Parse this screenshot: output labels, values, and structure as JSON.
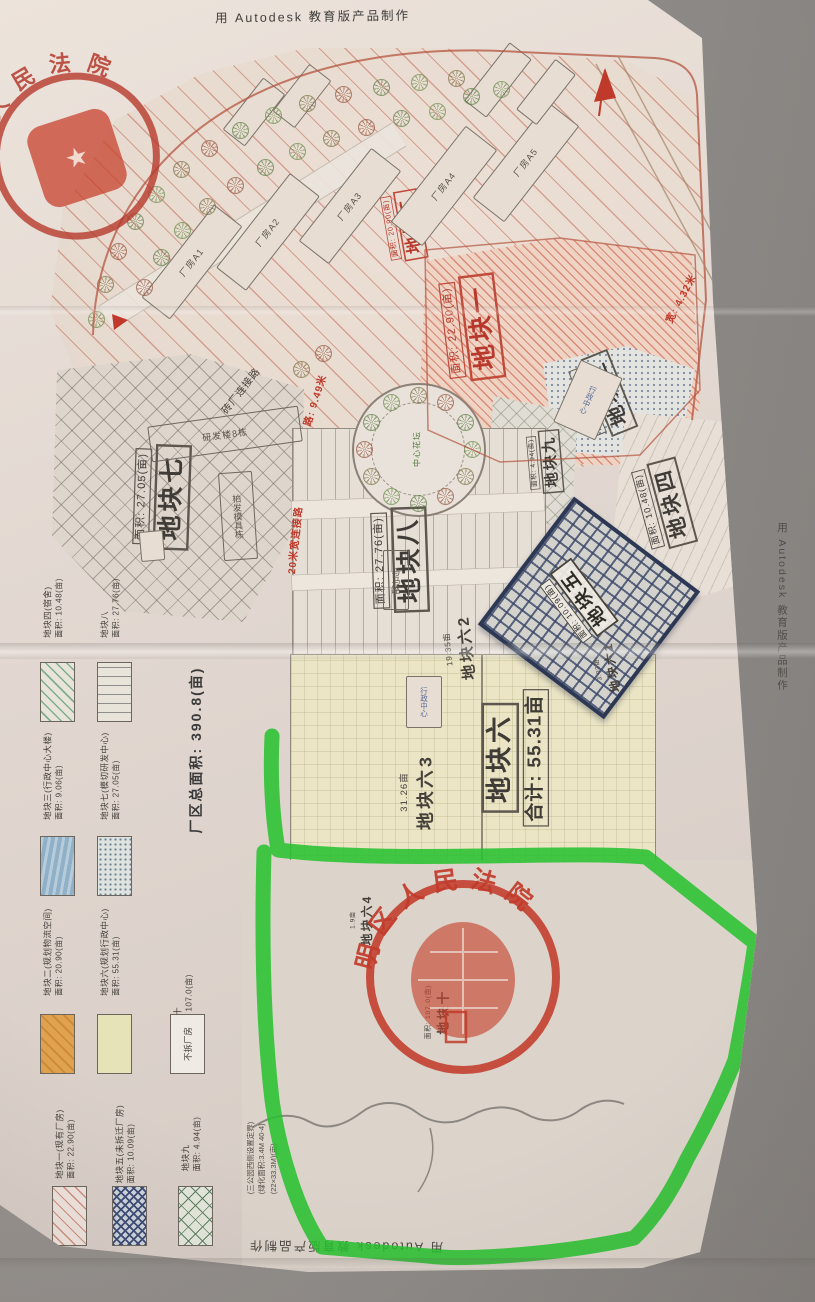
{
  "colors": {
    "marker_green": "#27c12f",
    "seal_red": "#c23b2a",
    "hatch_red": "#c05a46",
    "navy": "#35426b",
    "cream": "#ebe5c6"
  },
  "watermarks": {
    "top": "用 Autodesk 教育版产品制作",
    "bottom": "用 Autodesk 教育版产品制作",
    "right": "用 Autodesk 教育版产品制作"
  },
  "stamps": {
    "corner": {
      "arc_text": "人民法院"
    },
    "center": {
      "arc_text": "明区人民法院"
    }
  },
  "site": {
    "total_area": "厂区总面积: 390.8(亩)",
    "notes_l1": "(三公园西侧设置定界)",
    "notes_l2": "(绿化面积:3.4M 40-4)",
    "notes_l3": "(22×33.3M)(亩)"
  },
  "legend": {
    "items": [
      {
        "id": "p4",
        "x": 40,
        "ty": 556,
        "sy": 662,
        "sw": "hatch-green",
        "label": "地块四(宿舍)",
        "area": "面积: 10.48(亩)"
      },
      {
        "id": "p8",
        "x": 97,
        "ty": 556,
        "sy": 662,
        "sw": "lines-dash",
        "label": "地块八",
        "area": "面积: 27.76(亩)"
      },
      {
        "id": "p3",
        "x": 40,
        "ty": 724,
        "sy": 836,
        "sw": "solid-blue",
        "label": "地块三(行政中心大楼)",
        "area": "面积: 9.06(亩)"
      },
      {
        "id": "p7",
        "x": 97,
        "ty": 724,
        "sy": 836,
        "sw": "stipple",
        "label": "地块七(模切研发中心)",
        "area": "面积: 27.05(亩)"
      },
      {
        "id": "p2",
        "x": 40,
        "ty": 900,
        "sy": 1014,
        "sw": "solid-orange",
        "label": "地块二(规划物流空间)",
        "area": "面积: 20.90(亩)"
      },
      {
        "id": "p6",
        "x": 97,
        "ty": 900,
        "sy": 1014,
        "sw": "solid-cream",
        "label": "地块六(规划行政中心)",
        "area": "面积: 55.31(亩)"
      },
      {
        "id": "p10",
        "x": 170,
        "ty": 952,
        "sw": "none",
        "label": "地块十",
        "area": "面积: 107.0(亩)"
      },
      {
        "id": "keep",
        "x": 170,
        "sy": 1014,
        "sw": "box-empty",
        "label": "不拆厂房",
        "area": ""
      },
      {
        "id": "p1",
        "x": 52,
        "ty": 1092,
        "sy": 1186,
        "sw": "hatch-pink",
        "label": "地块一(现有厂房)",
        "area": "面积: 22.90(亩)"
      },
      {
        "id": "p5",
        "x": 112,
        "ty": 1092,
        "sy": 1186,
        "sw": "cross-navy",
        "label": "地块五(未拆迁厂房)",
        "area": "面积: 10.09(亩)"
      },
      {
        "id": "p9",
        "x": 178,
        "ty": 1092,
        "sy": 1186,
        "sw": "grid-green",
        "label": "地块九",
        "area": "面积: 4.94(亩)"
      }
    ]
  },
  "map": {
    "parcel_labels": [
      {
        "id": "p1",
        "name": "地块一",
        "area": "面积: 22.90(亩)",
        "style": "red",
        "x": 472,
        "y": 328,
        "rot": -97,
        "scale": 1.2
      },
      {
        "id": "p2",
        "name": "地块二",
        "area": "面积: 20.90(亩)",
        "style": "red",
        "x": 404,
        "y": 226,
        "rot": -100,
        "scale": 0.8
      },
      {
        "id": "p3",
        "name": "地块三",
        "area": "面积: 9.06(亩)",
        "style": "dark",
        "x": 602,
        "y": 396,
        "rot": -112,
        "scale": 0.95
      },
      {
        "id": "p4",
        "name": "地块四",
        "area": "面积: 10.48(亩)",
        "style": "dark",
        "x": 664,
        "y": 505,
        "rot": -105,
        "scale": 1.0
      },
      {
        "id": "p5",
        "name": "地块五",
        "area": "面积: 10.09(亩)",
        "style": "light",
        "x": 578,
        "y": 602,
        "rot": -127,
        "scale": 0.9
      },
      {
        "id": "p7",
        "name": "地块七",
        "area": "面积: 27.05(亩)",
        "style": "dark",
        "x": 162,
        "y": 497,
        "rot": -88,
        "scale": 1.2
      },
      {
        "id": "p8",
        "name": "地块八",
        "area": "面积: 27.76(亩)",
        "style": "dark",
        "x": 400,
        "y": 560,
        "rot": -92,
        "scale": 1.2
      },
      {
        "id": "p9",
        "name": "地块九",
        "area": "面积: 4.94(亩)",
        "style": "dark",
        "x": 545,
        "y": 462,
        "rot": -95,
        "scale": 0.72
      },
      {
        "id": "p6",
        "name": "地块六",
        "area": "合计: 55.31亩",
        "style": "dark",
        "x": 515,
        "y": 758,
        "rot": -90,
        "scale": 1.25,
        "name_first": true,
        "big_area": true
      },
      {
        "id": "p63",
        "name": "地块六3",
        "area": "31.26亩",
        "style": "plain",
        "x": 418,
        "y": 792,
        "rot": -90,
        "scale": 1.05
      },
      {
        "id": "p62",
        "name": "地块六2",
        "area": "19.35亩",
        "style": "plain",
        "x": 460,
        "y": 648,
        "rot": -96,
        "scale": 0.9
      },
      {
        "id": "p61",
        "name": "地块六1",
        "area": "3.03亩",
        "style": "plain",
        "x": 607,
        "y": 668,
        "rot": -100,
        "scale": 0.7
      },
      {
        "id": "p64",
        "name": "地块六4",
        "area": "1.9亩",
        "style": "plain",
        "x": 362,
        "y": 920,
        "rot": -90,
        "scale": 0.7
      },
      {
        "id": "p10",
        "name": "地块十",
        "area": "面积: 107.0(亩)",
        "style": "plain",
        "x": 438,
        "y": 1012,
        "rot": -90,
        "scale": 0.75
      }
    ],
    "buildings": [
      {
        "id": "a1",
        "label": "厂房A1",
        "x": 192,
        "y": 262,
        "w": 34,
        "h": 116,
        "rot": 38,
        "t": "rot"
      },
      {
        "id": "a2",
        "label": "厂房A2",
        "x": 268,
        "y": 232,
        "w": 36,
        "h": 118,
        "rot": 38,
        "t": "rot"
      },
      {
        "id": "a3",
        "label": "厂房A3",
        "x": 350,
        "y": 206,
        "w": 36,
        "h": 116,
        "rot": 38,
        "t": "rot"
      },
      {
        "id": "a4",
        "label": "厂房A4",
        "x": 444,
        "y": 186,
        "w": 38,
        "h": 120,
        "rot": 38,
        "t": "rot"
      },
      {
        "id": "a5",
        "label": "厂房A5",
        "x": 526,
        "y": 162,
        "w": 38,
        "h": 120,
        "rot": 38,
        "t": "rot"
      },
      {
        "id": "s1",
        "label": "",
        "x": 254,
        "y": 112,
        "w": 26,
        "h": 64,
        "rot": 38
      },
      {
        "id": "s2",
        "label": "",
        "x": 302,
        "y": 96,
        "w": 26,
        "h": 58,
        "rot": 38
      },
      {
        "id": "s3",
        "label": "",
        "x": 498,
        "y": 80,
        "w": 26,
        "h": 72,
        "rot": 38
      },
      {
        "id": "s4",
        "label": "",
        "x": 546,
        "y": 92,
        "w": 24,
        "h": 62,
        "rot": 38
      },
      {
        "id": "admin1",
        "label": "行政中心",
        "x": 588,
        "y": 400,
        "w": 44,
        "h": 66,
        "rot": 24,
        "t": "v",
        "cls": "admin"
      },
      {
        "id": "admin2",
        "label": "行政中心",
        "x": 424,
        "y": 702,
        "w": 34,
        "h": 50,
        "rot": 0,
        "t": "v",
        "cls": "admin"
      },
      {
        "id": "rdlou",
        "label": "研发楼8栋",
        "x": 225,
        "y": 434,
        "w": 150,
        "h": 34,
        "rot": -8,
        "t": "h",
        "cls": "plain"
      },
      {
        "id": "bfmj",
        "label": "柏发模具栋",
        "x": 238,
        "y": 516,
        "w": 32,
        "h": 86,
        "rot": -4,
        "t": "v",
        "cls": "plain"
      },
      {
        "id": "ymr",
        "label": "与马路",
        "x": 396,
        "y": 580,
        "w": 24,
        "h": 58,
        "rot": 0,
        "t": "v",
        "cls": "plain"
      },
      {
        "id": "pd",
        "label": "",
        "x": 152,
        "y": 546,
        "w": 22,
        "h": 28,
        "rot": -5
      }
    ],
    "road_texts": [
      {
        "id": "w949",
        "text": "路: 9.49米",
        "x": 314,
        "y": 400,
        "rot": -72,
        "c": "red"
      },
      {
        "id": "conn20",
        "text": "20米宽连接路",
        "x": 294,
        "y": 540,
        "rot": -84,
        "c": "red"
      },
      {
        "id": "w432",
        "text": "宽: 4.32米",
        "x": 680,
        "y": 298,
        "rot": -62,
        "c": "red"
      },
      {
        "id": "connbrick",
        "text": "砖厂连接路",
        "x": 240,
        "y": 390,
        "rot": -52,
        "c": "dark"
      },
      {
        "id": "flowerbed",
        "text": "中心花坛",
        "x": 417,
        "y": 449,
        "rot": -90,
        "c": "green"
      }
    ],
    "trees": [
      [
        95,
        318
      ],
      [
        104,
        283
      ],
      [
        117,
        250
      ],
      [
        134,
        220
      ],
      [
        155,
        193
      ],
      [
        180,
        168
      ],
      [
        208,
        147
      ],
      [
        239,
        129
      ],
      [
        272,
        114
      ],
      [
        306,
        102
      ],
      [
        342,
        93
      ],
      [
        380,
        86
      ],
      [
        418,
        81
      ],
      [
        455,
        77
      ],
      [
        143,
        286
      ],
      [
        160,
        256
      ],
      [
        181,
        229
      ],
      [
        206,
        205
      ],
      [
        234,
        184
      ],
      [
        264,
        166
      ],
      [
        296,
        150
      ],
      [
        330,
        137
      ],
      [
        365,
        126
      ],
      [
        400,
        117
      ],
      [
        436,
        110
      ],
      [
        300,
        368
      ],
      [
        322,
        352
      ],
      [
        470,
        95
      ],
      [
        500,
        88
      ]
    ],
    "roundabout": {
      "cx": 417,
      "cy": 448,
      "r": 54,
      "count": 12
    }
  }
}
